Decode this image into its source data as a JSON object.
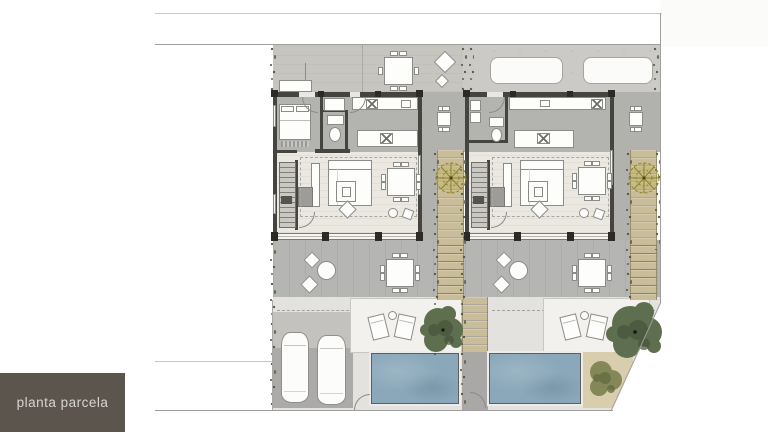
{
  "meta": {
    "width": 768,
    "height": 432,
    "drawing_type": "architectural-site-plan"
  },
  "title_block": {
    "label": "planta parcela"
  },
  "palette": {
    "wall": "#45443f",
    "column": "#2b2a27",
    "furn-white": "#fdfdfb",
    "furn-border": "#8b8b88",
    "terr-front-left": "#c7c5c0",
    "terr-front-right": "#cbcac6",
    "terr-rear": "#b5b6b3",
    "room-gray": "#b3b3af",
    "living-floor": "#ebe8e1",
    "paving": "#e3e2df",
    "deck": "#f2f1ee",
    "pad": "#abaaa8",
    "pool-water": "#8aa8ba",
    "pool-edge": "#5f5f5c",
    "path-olive": "#b2a77b",
    "stone-tan": "#c9bd99",
    "sand": "#d8cead",
    "tree-green": "#5e6f50",
    "tree-green-dark": "#46543b",
    "tree-yellow": "#8f8128",
    "hedge": "#4c5a3e",
    "boundary": "#9e9e9d",
    "dashed": "#a3a29f",
    "label-bg": "#5b554e",
    "label-text": "#d8d4cf"
  },
  "plan": {
    "plot": {
      "shape": "corner plot, chamfered lower-right corner",
      "pools": 2,
      "units": 2
    },
    "unit_a": {
      "position": "left",
      "front_terrace": [
        "outdoor-dining-table-6-chairs",
        "lounge-cushion-large",
        "lounge-cushion-small",
        "bench"
      ],
      "interior": [
        "bed",
        "wardrobe",
        "bathroom-sink",
        "toilet",
        "kitchen-counter",
        "hob",
        "kitchen-island",
        "staircase",
        "tv-console",
        "side-desk",
        "sofa",
        "coffee-table",
        "floor-cushion",
        "dining-table-8-chairs",
        "pouf-round",
        "pouf-square"
      ],
      "rear_terrace": [
        "bistro-table-2-seats",
        "outdoor-dining-table-8-chairs"
      ],
      "garden": [
        "side-table-4-chairs",
        "olive-path-tree",
        "green-tree",
        "sun-loungers-2",
        "lounger-side-table",
        "swimming-pool",
        "parking-2-cars"
      ]
    },
    "unit_b": {
      "position": "right",
      "front_terrace": [
        "parking-pad",
        "parking-pad"
      ],
      "interior": [
        "laundry-unit",
        "cabinet",
        "bathroom-sink",
        "toilet",
        "kitchen-counter",
        "hob",
        "kitchen-island",
        "staircase",
        "tv-console",
        "side-desk",
        "sofa",
        "coffee-table",
        "floor-cushion",
        "dining-table-8-chairs",
        "pouf-round",
        "pouf-square"
      ],
      "rear_terrace": [
        "bistro-table-2-seats",
        "outdoor-dining-table-8-chairs"
      ],
      "garden": [
        "side-table-4-chairs",
        "olive-path-tree",
        "green-tree",
        "sun-loungers-2",
        "lounger-side-table",
        "swimming-pool",
        "corner-sand-garden-bush"
      ]
    }
  }
}
